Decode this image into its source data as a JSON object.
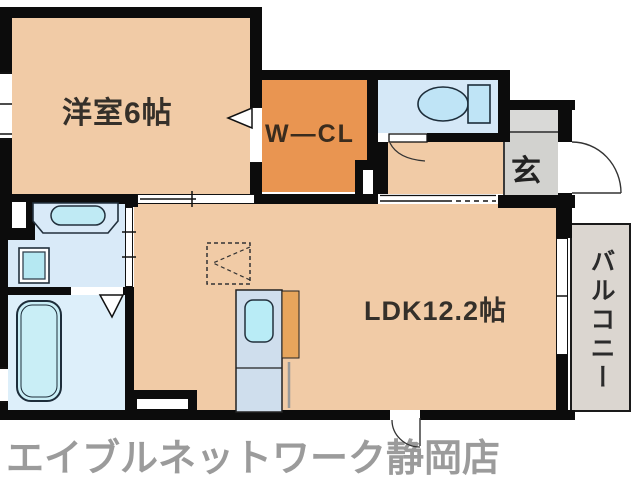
{
  "floorplan": {
    "rooms": {
      "western_room": {
        "label": "洋室6帖"
      },
      "walk_in_closet": {
        "label": "W―CL"
      },
      "entrance": {
        "label": "玄"
      },
      "ldk": {
        "label": "LDK12.2帖"
      },
      "balcony": {
        "label": "バルコニー"
      }
    },
    "fixtures": [
      {
        "name": "toilet-icon"
      },
      {
        "name": "bathtub-icon"
      },
      {
        "name": "vanity-sink-icon"
      },
      {
        "name": "washing-machine-pan-icon"
      },
      {
        "name": "kitchen-sink-icon"
      },
      {
        "name": "refrigerator-space-marker"
      },
      {
        "name": "entrance-door-swing"
      },
      {
        "name": "toilet-door-swing"
      },
      {
        "name": "bathroom-folding-door"
      },
      {
        "name": "closet-door-triangle"
      }
    ],
    "colors": {
      "room_peach": "#f1cba6",
      "closet_orange": "#e99551",
      "water_area_blue": "#d9eaf8",
      "toilet_room_blue": "#d5e8f7",
      "bathroom_blue": "#ddeffa",
      "fixture_cyan": "#bfeaf4",
      "kitchen_unit_blue": "#cfdeed",
      "kitchen_counter_orange": "#e7a55c",
      "entrance_gray": "#d2d2cf",
      "balcony_gray": "#dbd6d0",
      "wall_black": "#0c0c0c",
      "logo_gray": "#9b9b9b"
    }
  },
  "footer": {
    "store_name": "エイブルネットワーク静岡店"
  }
}
